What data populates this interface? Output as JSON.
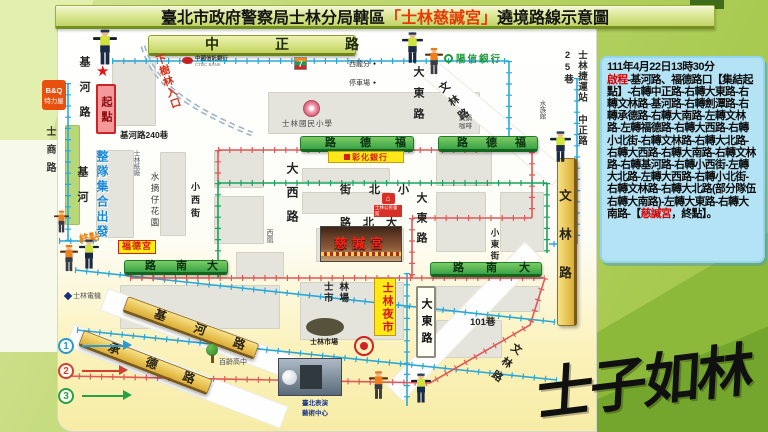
{
  "title": {
    "prefix": "臺北市政府警察局士林分局轄區",
    "highlight": "「士林慈諴宮」",
    "suffix": "遶境路線示意圖"
  },
  "info_panel": {
    "date_line": "111年4月22日13時30分",
    "segments": [
      {
        "text": "啟程"
      },
      {
        "text": "-基河路、福德路口【集結起點】-右轉中正路-右轉大東路-右轉文林路-基河路-右轉劍潭路-右轉承德路-右轉大南路-左轉文林路-左轉福德路-右轉大西路-右轉小北街-右轉文林路-右轉大北路-右轉大西路-右轉大南路-右轉文林路-右轉基河路-右轉小西街-左轉大北路-左轉大西路-右轉小北街-右轉文林路-右轉大北路(部分隊伍右轉大南路)-左轉大東路-右轉大南路-【"
      },
      {
        "text": "慈諴宮"
      },
      {
        "text": "，終點】。"
      }
    ]
  },
  "calligraphy": "士子如林",
  "legend": {
    "items": [
      {
        "num": "1"
      },
      {
        "num": "2"
      },
      {
        "num": "3"
      }
    ]
  },
  "map": {
    "signs": {
      "zhongzheng": "中正路",
      "fude": "路德福",
      "danan": "路南大",
      "jihe": "基河路",
      "chengde": "承德路",
      "wenlin": "文林路",
      "dadong": "大東路",
      "nightmarket": "士林夜市",
      "qidian": "起點",
      "fudegong": "福德宮"
    },
    "labels": {
      "jihe_upper": "基河路",
      "jihe_lower": "基河",
      "shishang": "士商路",
      "jihe240": "基河路240巷",
      "daxi": "大西路",
      "xiaoxi": "小西街",
      "xiaobei": "街北小",
      "dabei": "路北大",
      "dadong_top": "大東路",
      "dadong_mid": "大東路",
      "xiaodong": "小東街",
      "wenlin_ne": "文林路",
      "wenlin_se": "文林路",
      "lane101": "101巷",
      "market_area": "士林市場"
    },
    "landmarks": {
      "ctbc": "中國信託銀行",
      "ctbc_en": "CTBC BANK",
      "seven": "7",
      "xilong": "西龍分",
      "parking": "停車場",
      "dot": "●",
      "school": "士林國民小學",
      "sunny": "陽信銀行",
      "mrt": "士林捷運站 中正路25巷",
      "aquarium": "水族館",
      "cafe": "真鍋咖啡",
      "paper": "士林紙廠",
      "garden": "水摘仔花園",
      "changhwa": "彰化銀行",
      "hall": "士林公民會館",
      "house_glyph": "⌂",
      "xihuang": "西凰",
      "temple": "慈諴宮",
      "market": "士林市場",
      "paca_caption1": "臺北表演",
      "paca_caption2": "藝術中心",
      "bailing": "百齡高中",
      "electric": "士林電機",
      "bq_top": "B&Q",
      "bq_bottom": "特力屋"
    },
    "annotations": {
      "assembly": "整隊集合出發",
      "end_point": "終點",
      "xiashulin": "下樹林入口",
      "star": "★"
    }
  },
  "colors": {
    "title_highlight": "#e83808",
    "panel_bg": "#b5e3f6",
    "route_blue": "#2aa8d8",
    "route_red": "#e05858",
    "route_green": "#17a35c",
    "sign_green": "#3aa348",
    "sign_yellow": "#e8c34a"
  }
}
